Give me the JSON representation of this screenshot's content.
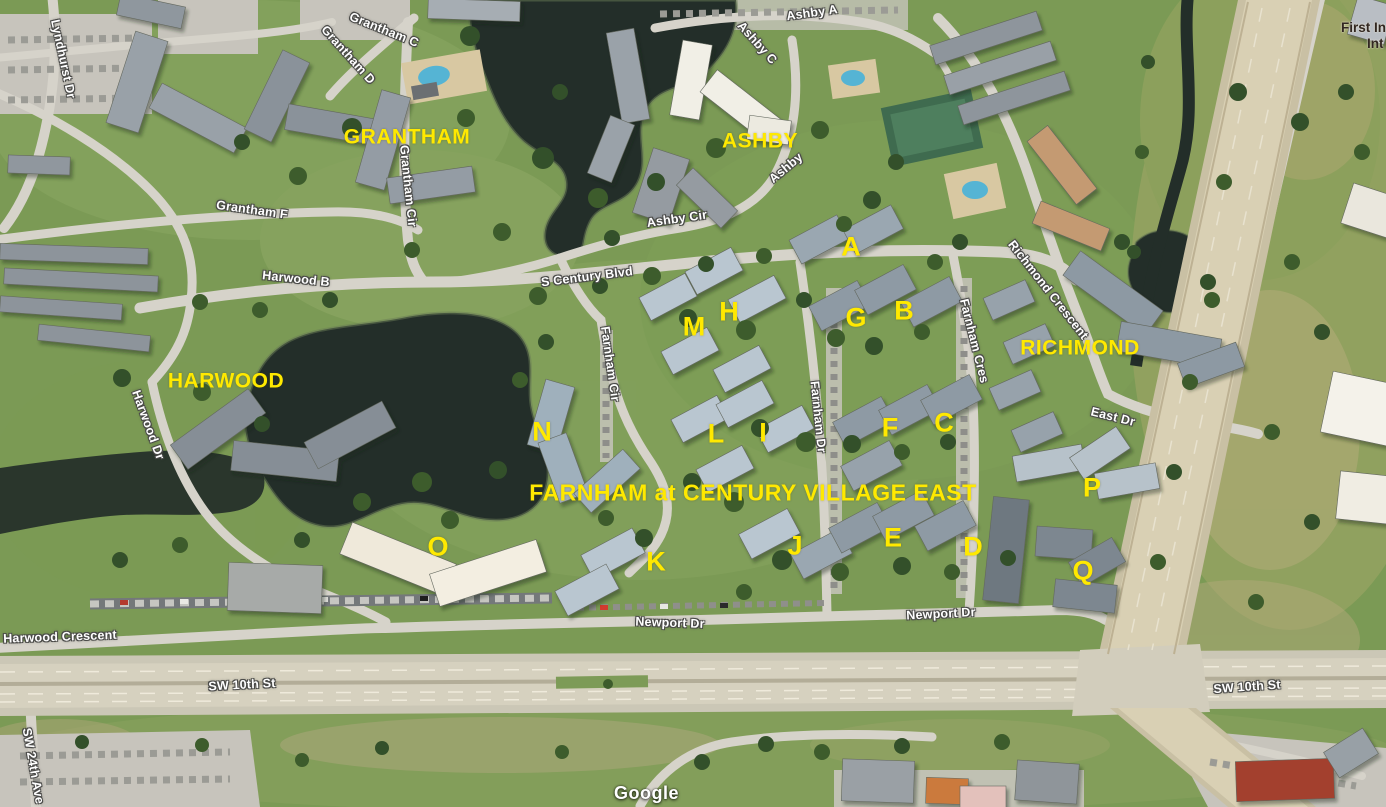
{
  "map": {
    "provider_watermark": "Google",
    "community_title": {
      "text": "FARNHAM at CENTURY VILLAGE EAST",
      "x": 753,
      "y": 493
    },
    "area_labels": [
      {
        "text": "GRANTHAM",
        "x": 407,
        "y": 137
      },
      {
        "text": "ASHBY",
        "x": 760,
        "y": 141
      },
      {
        "text": "HARWOOD",
        "x": 226,
        "y": 381
      },
      {
        "text": "RICHMOND",
        "x": 1080,
        "y": 348
      }
    ],
    "building_letters": [
      {
        "text": "A",
        "x": 851,
        "y": 247
      },
      {
        "text": "B",
        "x": 904,
        "y": 311
      },
      {
        "text": "C",
        "x": 944,
        "y": 423
      },
      {
        "text": "D",
        "x": 973,
        "y": 547
      },
      {
        "text": "E",
        "x": 893,
        "y": 538
      },
      {
        "text": "F",
        "x": 890,
        "y": 428
      },
      {
        "text": "G",
        "x": 856,
        "y": 318
      },
      {
        "text": "H",
        "x": 729,
        "y": 312
      },
      {
        "text": "I",
        "x": 763,
        "y": 433
      },
      {
        "text": "J",
        "x": 795,
        "y": 546
      },
      {
        "text": "K",
        "x": 656,
        "y": 562
      },
      {
        "text": "L",
        "x": 716,
        "y": 434
      },
      {
        "text": "M",
        "x": 694,
        "y": 327
      },
      {
        "text": "N",
        "x": 542,
        "y": 432
      },
      {
        "text": "O",
        "x": 438,
        "y": 547
      },
      {
        "text": "P",
        "x": 1092,
        "y": 488
      },
      {
        "text": "Q",
        "x": 1083,
        "y": 571
      }
    ],
    "street_labels": [
      {
        "text": "Ashby A",
        "x": 812,
        "y": 13,
        "rot": -8
      },
      {
        "text": "Ashby C",
        "x": 757,
        "y": 43,
        "rot": 48
      },
      {
        "text": "Ashby",
        "x": 786,
        "y": 168,
        "rot": -40
      },
      {
        "text": "Ashby Cir",
        "x": 677,
        "y": 219,
        "rot": -8
      },
      {
        "text": "Grantham C",
        "x": 384,
        "y": 30,
        "rot": 22
      },
      {
        "text": "Grantham D",
        "x": 348,
        "y": 55,
        "rot": 48
      },
      {
        "text": "Grantham Cir",
        "x": 408,
        "y": 186,
        "rot": 84
      },
      {
        "text": "Grantham F",
        "x": 252,
        "y": 210,
        "rot": 8
      },
      {
        "text": "Harwood B",
        "x": 296,
        "y": 279,
        "rot": 6
      },
      {
        "text": "Lyndhurst Dr",
        "x": 63,
        "y": 59,
        "rot": 78
      },
      {
        "text": "S Century Blvd",
        "x": 587,
        "y": 277,
        "rot": -7
      },
      {
        "text": "Farnham Cir",
        "x": 610,
        "y": 364,
        "rot": 82
      },
      {
        "text": "Farnham Dr",
        "x": 818,
        "y": 417,
        "rot": 84
      },
      {
        "text": "Farnham Cres",
        "x": 974,
        "y": 341,
        "rot": 76
      },
      {
        "text": "Richmond Crescent",
        "x": 1048,
        "y": 290,
        "rot": 52
      },
      {
        "text": "East Dr",
        "x": 1113,
        "y": 417,
        "rot": 14
      },
      {
        "text": "Harwood Dr",
        "x": 148,
        "y": 425,
        "rot": 70
      },
      {
        "text": "Harwood Crescent",
        "x": 60,
        "y": 637,
        "rot": -2
      },
      {
        "text": "Newport Dr",
        "x": 670,
        "y": 623,
        "rot": 2
      },
      {
        "text": "Newport Dr",
        "x": 941,
        "y": 614,
        "rot": -3
      },
      {
        "text": "SW 10th St",
        "x": 242,
        "y": 685,
        "rot": -3
      },
      {
        "text": "SW 10th St",
        "x": 1247,
        "y": 687,
        "rot": -4
      },
      {
        "text": "SW 24th Ave",
        "x": 33,
        "y": 766,
        "rot": 80
      }
    ],
    "poi_label": {
      "line1": "First In",
      "line2": "Int",
      "x": 1343,
      "y": 24
    },
    "colors": {
      "label_yellow": "#ffe900",
      "street_label": "#ffffff",
      "street_halo": "#4a4a48",
      "poi_text": "#312721",
      "water": "#232e29",
      "grass": "#7b9a55",
      "road": "#d6d3ca",
      "highway": "#d9d0b4"
    }
  }
}
